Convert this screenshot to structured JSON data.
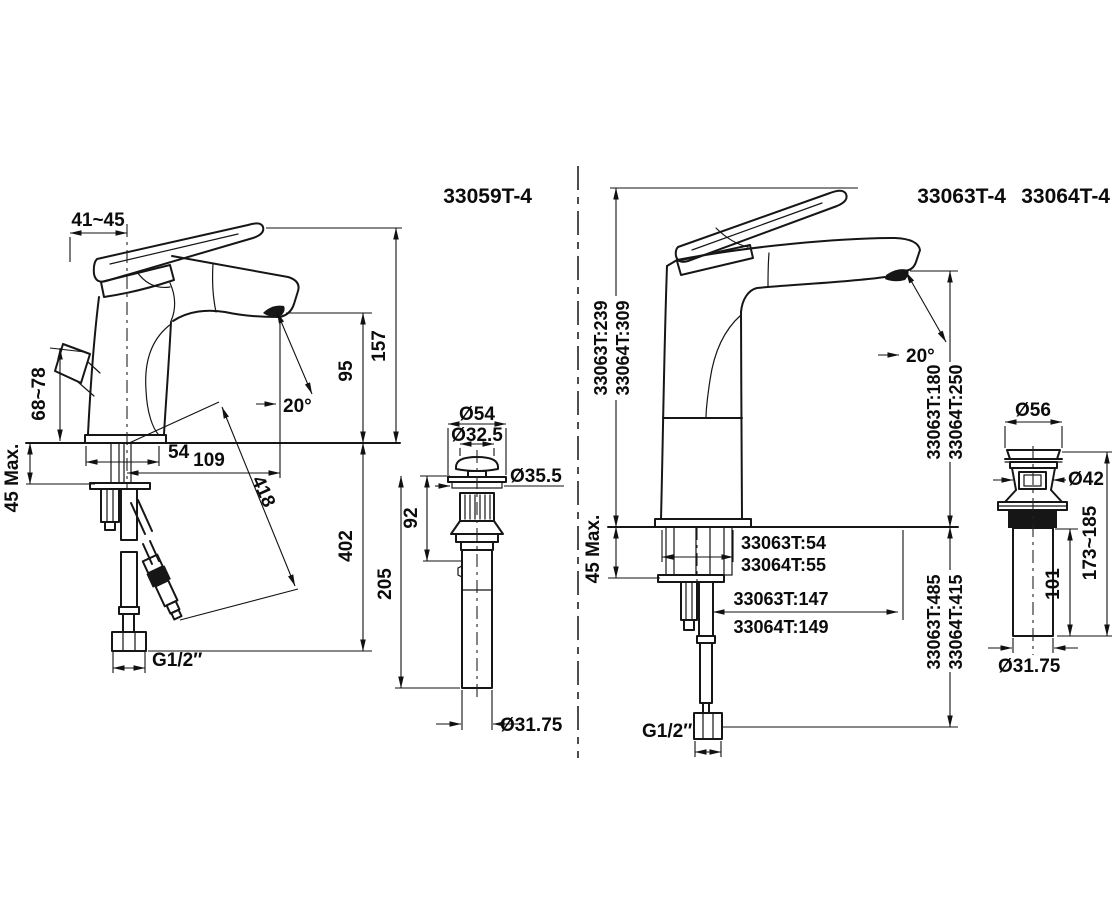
{
  "left": {
    "title": "33059T-4",
    "dims": {
      "top_width": "41~45",
      "side_handle_height": "68~78",
      "deck_thickness": "45 Max.",
      "overall_height": "157",
      "spout_height": "95",
      "spray_angle": "20°",
      "base_width": "54",
      "spout_reach": "109",
      "hose_length": "418",
      "below_deck_depth": "402",
      "inlet_thread": "G1/2″"
    },
    "drain": {
      "cap_diameter": "Ø54",
      "plug_diameter": "Ø32.5",
      "flange_diameter": "Ø35.5",
      "body_length": "92",
      "overall_length": "205",
      "tailpiece_diameter": "Ø31.75"
    }
  },
  "right": {
    "title_a": "33063T-4",
    "title_b": "33064T-4",
    "dims": {
      "overall_height_a": "33063T:239",
      "overall_height_b": "33064T:309",
      "deck_thickness": "45 Max.",
      "spray_angle": "20°",
      "spout_height_a": "33063T:180",
      "spout_height_b": "33064T:250",
      "base_width_a": "33063T:54",
      "base_width_b": "33064T:55",
      "spout_reach_a": "33063T:147",
      "spout_reach_b": "33064T:149",
      "below_deck_depth_a": "33063T:485",
      "below_deck_depth_b": "33064T:415",
      "inlet_thread": "G1/2″"
    },
    "drain": {
      "cap_diameter": "Ø56",
      "body_diameter": "Ø42",
      "overall_length": "173~185",
      "tailpiece_length": "101",
      "tailpiece_diameter": "Ø31.75"
    }
  }
}
